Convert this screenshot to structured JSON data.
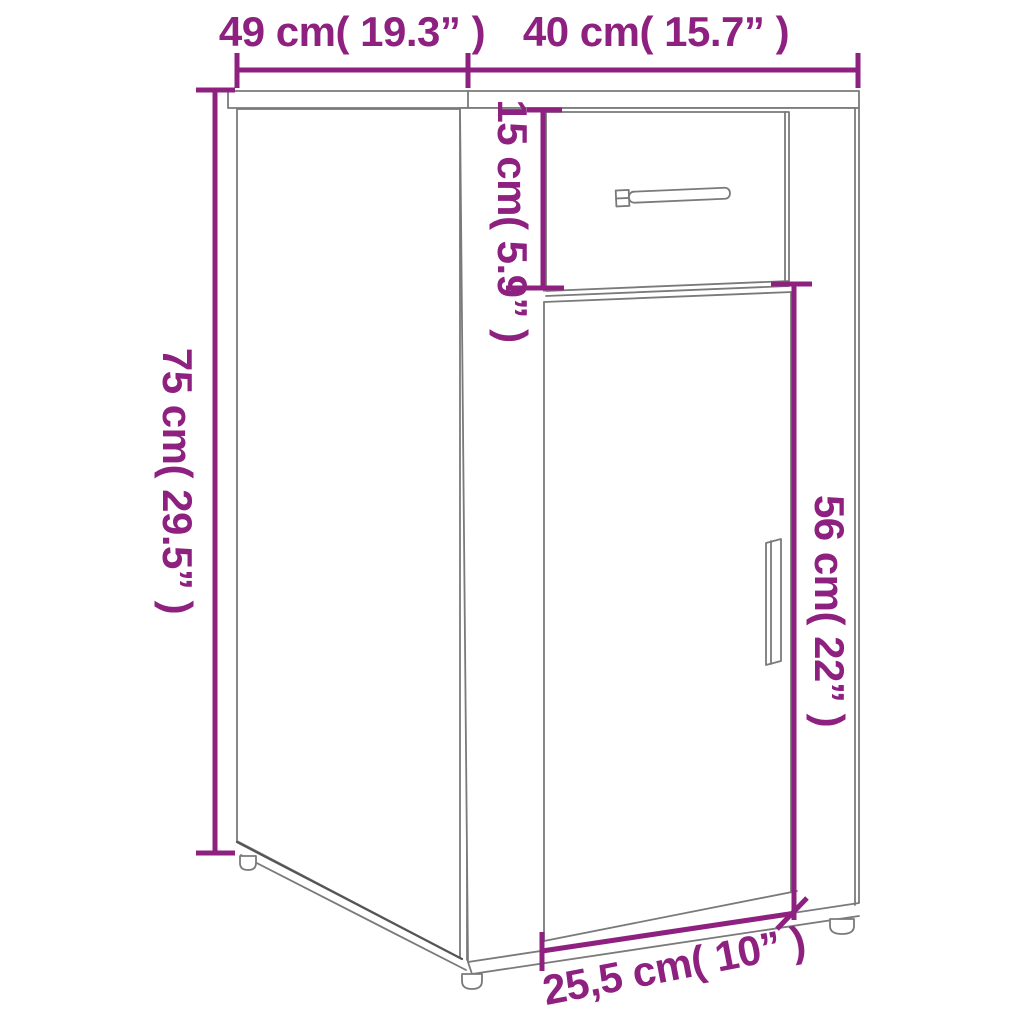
{
  "page": {
    "kind": "furniture dimension diagram",
    "subject": "desk cabinet with drawer and door, line drawing with dimension annotations"
  },
  "colors": {
    "dimension": "#8e2080",
    "outline": "#7a7a7a",
    "outline_dark": "#555555",
    "background": "#ffffff"
  },
  "dimensions": {
    "top_depth": {
      "text": "49 cm( 19.3” )",
      "cm": 49,
      "inches": 19.3,
      "orientation": "horizontal"
    },
    "top_width": {
      "text": "40 cm( 15.7” )",
      "cm": 40,
      "inches": 15.7,
      "orientation": "horizontal"
    },
    "height": {
      "text": "75 cm( 29.5” )",
      "cm": 75,
      "inches": 29.5,
      "orientation": "vertical"
    },
    "drawer_height": {
      "text": "15 cm( 5.9” )",
      "cm": 15,
      "inches": 5.9,
      "orientation": "vertical"
    },
    "door_height": {
      "text": "56 cm( 22” )",
      "cm": 56,
      "inches": 22,
      "orientation": "vertical"
    },
    "door_width": {
      "text": "25,5 cm( 10” )",
      "cm": 25.5,
      "inches": 10,
      "orientation": "slanted"
    }
  }
}
